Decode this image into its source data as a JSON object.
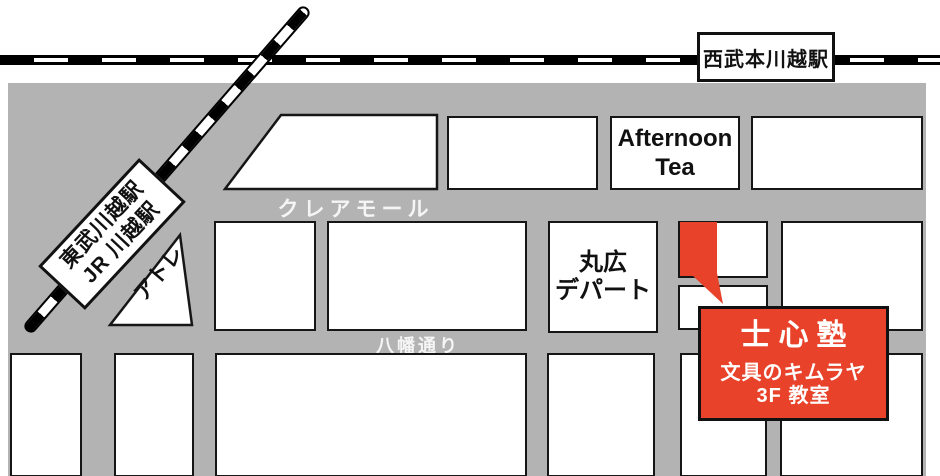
{
  "map": {
    "stations": {
      "seibu": "西武本川越駅",
      "tobu_line1": "東武川越駅",
      "tobu_line2": "JR 川越駅"
    },
    "streets": {
      "crea_mall": "クレアモール",
      "hachiman_dori": "八幡通り"
    },
    "landmarks": {
      "afternoon_tea_line1": "Afternoon",
      "afternoon_tea_line2": "Tea",
      "maruhiro_line1": "丸広",
      "maruhiro_line2": "デパート",
      "atre": "アトレ"
    },
    "destination": {
      "name": "士心塾",
      "building": "文具のキムラヤ",
      "floor": "3F 教室"
    },
    "colors": {
      "road_gray": "#b3b3b3",
      "block_white": "#ffffff",
      "accent_red": "#e8432a",
      "outline_black": "#161616"
    }
  }
}
